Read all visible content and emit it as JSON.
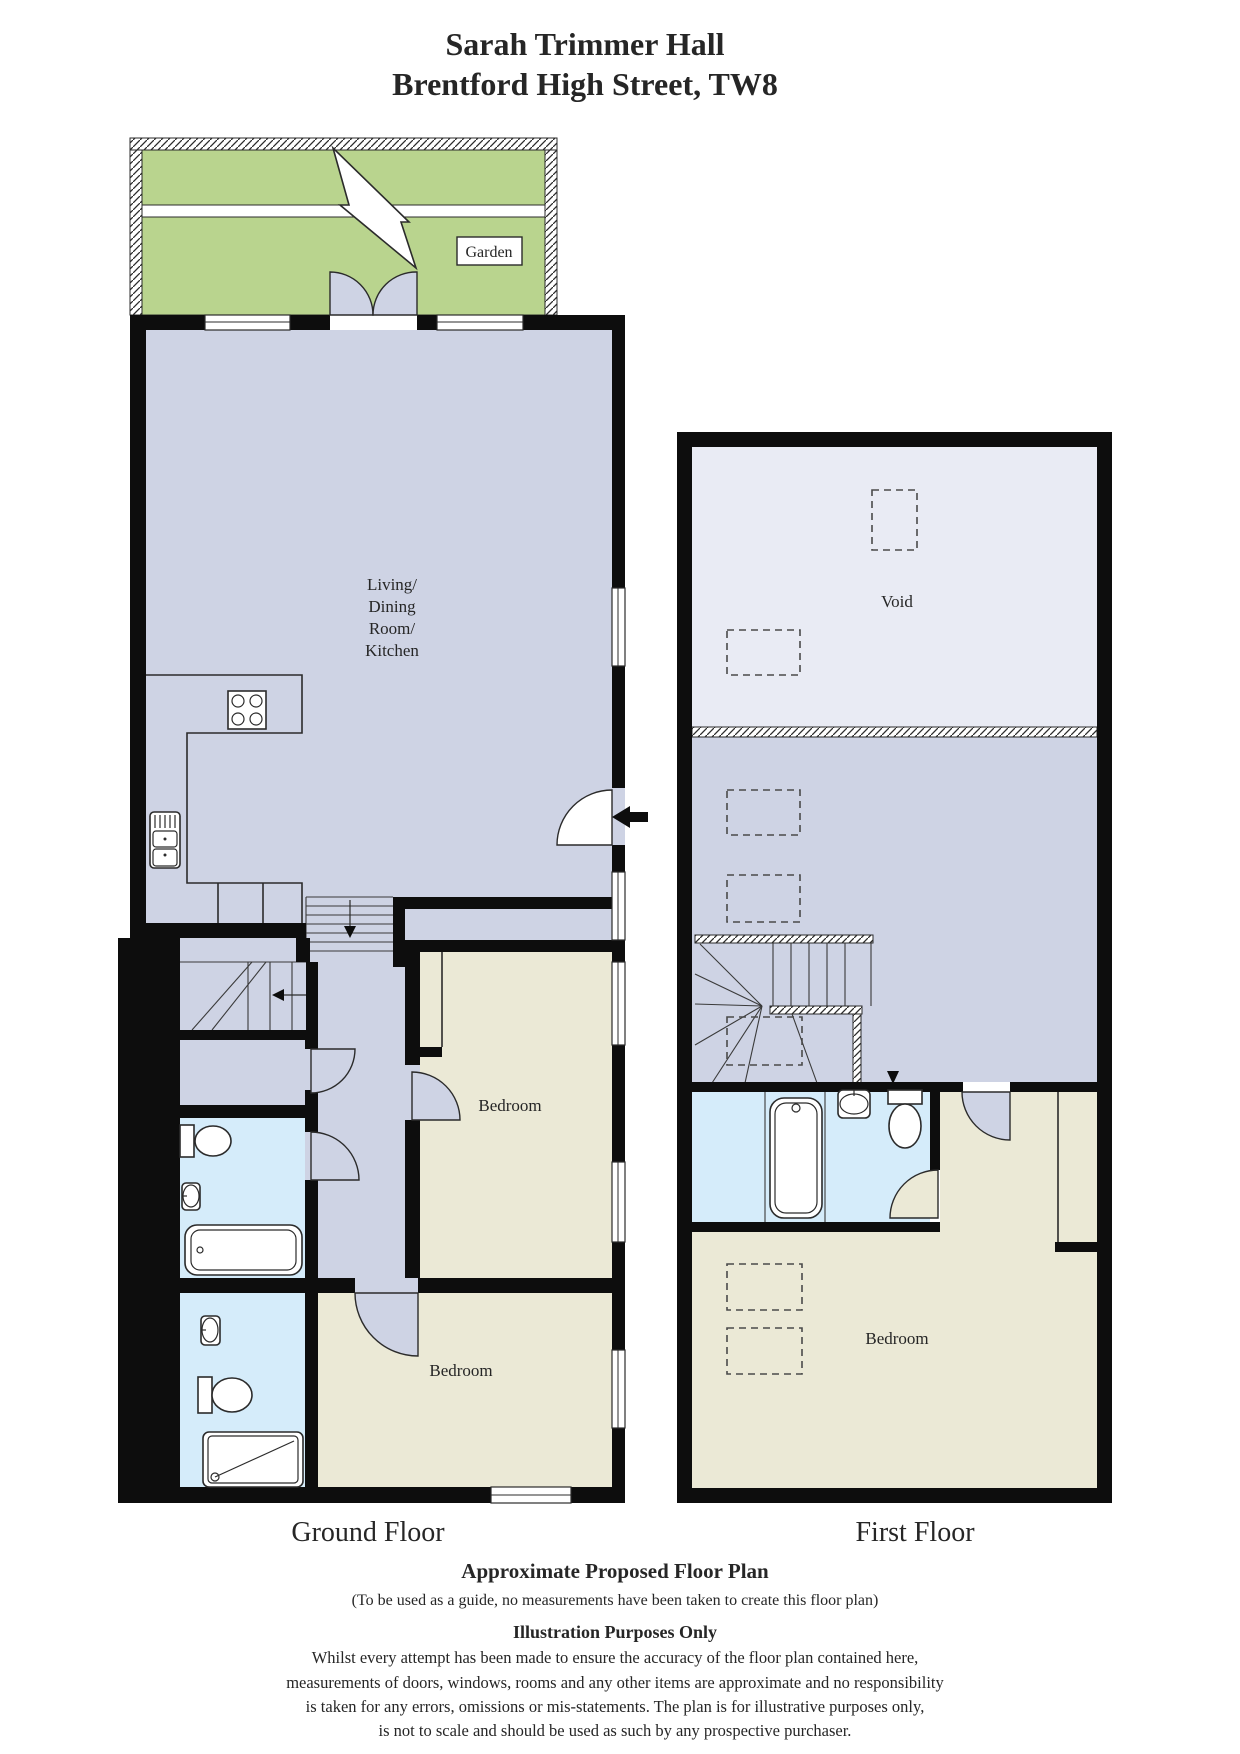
{
  "page": {
    "title_line1": "Sarah Trimmer Hall",
    "title_line2": "Brentford High Street, TW8"
  },
  "ground_floor": {
    "label": "Ground Floor",
    "garden_label": "Garden",
    "living_label_line1": "Living/",
    "living_label_line2": "Dining",
    "living_label_line3": "Room/",
    "living_label_line4": "Kitchen",
    "bedroom1_label": "Bedroom",
    "bedroom2_label": "Bedroom"
  },
  "first_floor": {
    "label": "First Floor",
    "void_label": "Void",
    "bedroom_label": "Bedroom"
  },
  "footer": {
    "heading": "Approximate Proposed Floor Plan",
    "subheading": "(To be used as a guide, no measurements have been taken to create this floor plan)",
    "purpose": "Illustration Purposes Only",
    "disclaimer_line1": "Whilst every attempt has been made to ensure the accuracy of the floor plan contained here,",
    "disclaimer_line2": "measurements of doors, windows, rooms and any other items are approximate and no responsibility",
    "disclaimer_line3": "is taken for any errors, omissions or mis-statements. The plan is for illustrative purposes only,",
    "disclaimer_line4": "is not to scale and should be used as such by any prospective purchaser."
  },
  "colors": {
    "garden": "#b9d48e",
    "living": "#ced3e4",
    "void": "#e9ebf4",
    "bedroom": "#ebe9d6",
    "bathroom": "#d5ecfa",
    "wall": "#0d0d0d"
  }
}
